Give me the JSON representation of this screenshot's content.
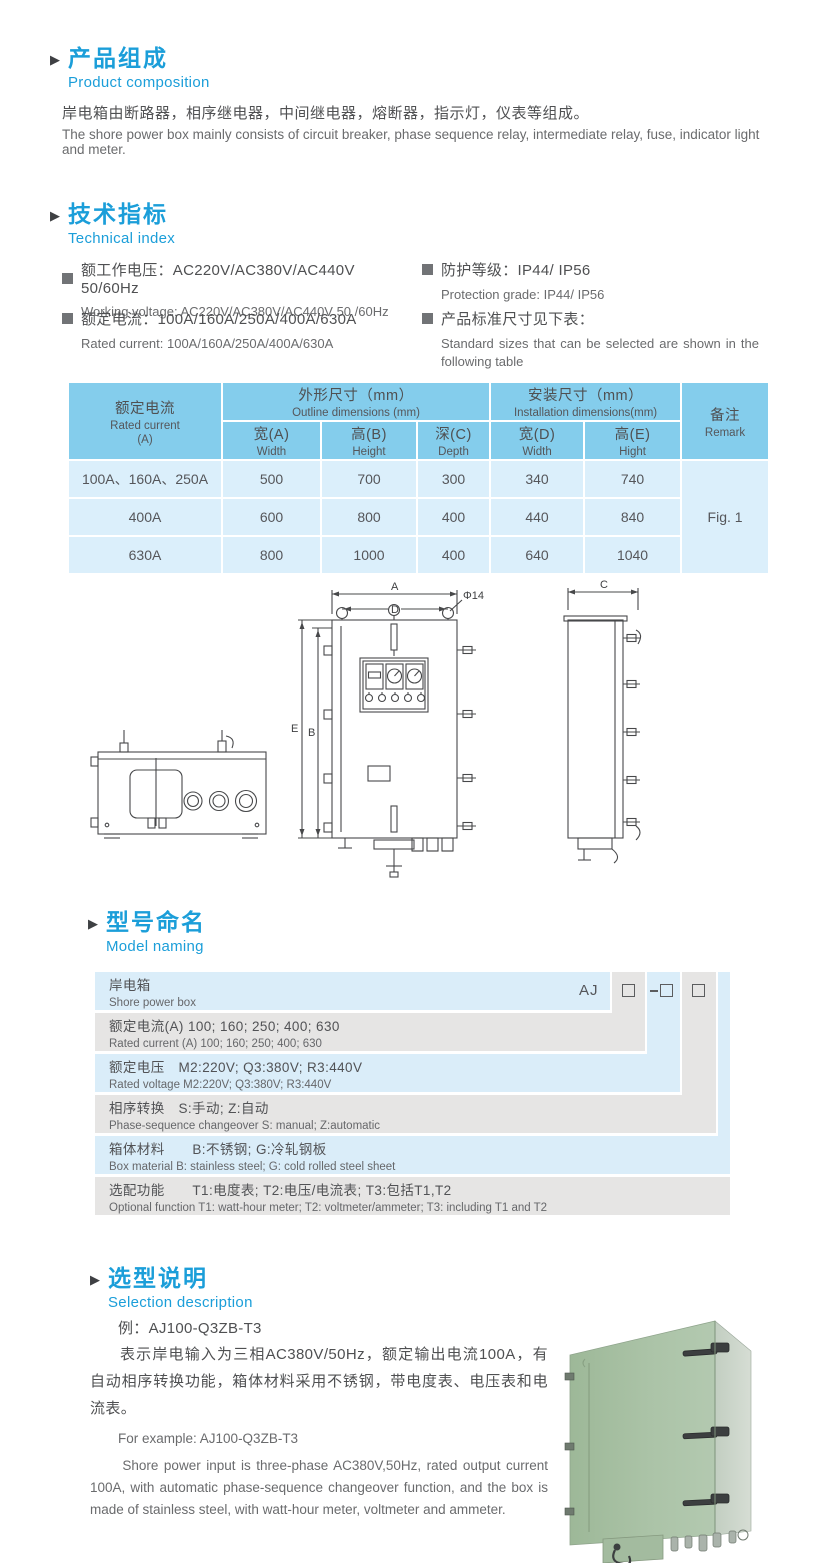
{
  "colors": {
    "accent_blue": "#1b9ed9",
    "table_header_bg": "#84cdec",
    "table_row_bg": "#dbeffb",
    "naming_blue": "#daedf9",
    "naming_gray": "#e6e5e4",
    "cabinet_green": "#a9c2a6",
    "text": "#57585a"
  },
  "composition": {
    "title_zh": "产品组成",
    "title_en": "Product  composition",
    "body_zh": "岸电箱由断路器，相序继电器，中间继电器，熔断器，指示灯，仪表等组成。",
    "body_en": "The shore power box mainly consists of circuit breaker, phase sequence relay, intermediate relay, fuse, indicator light and meter."
  },
  "technical": {
    "title_zh": "技术指标",
    "title_en": "Technical index",
    "specs": [
      {
        "zh": "额工作电压：AC220V/AC380V/AC440V  50/60Hz",
        "en": "Working voltage: AC220V/AC380V/AC440V 50 /60Hz"
      },
      {
        "zh": "额定电流：100A/160A/250A/400A/630A",
        "en": "Rated current: 100A/160A/250A/400A/630A"
      },
      {
        "zh": "防护等级：IP44/ IP56",
        "en": "Protection grade: IP44/ IP56"
      },
      {
        "zh": "产品标准尺寸见下表：",
        "en": "Standard sizes that can be selected are shown in the following table"
      }
    ]
  },
  "table": {
    "col_current": {
      "zh": "额定电流",
      "en": "Rated current",
      "unit": "(A)"
    },
    "group_outline": {
      "zh": "外形尺寸（mm）",
      "en": "Outline dimensions (mm)"
    },
    "group_install": {
      "zh": "安装尺寸（mm）",
      "en": "Installation dimensions(mm)"
    },
    "col_remark": {
      "zh": "备注",
      "en": "Remark"
    },
    "sub": [
      {
        "zh": "宽(A)",
        "en": "Width"
      },
      {
        "zh": "高(B)",
        "en": "Height"
      },
      {
        "zh": "深(C)",
        "en": "Depth"
      },
      {
        "zh": "宽(D)",
        "en": "Width"
      },
      {
        "zh": "高(E)",
        "en": "Hight"
      }
    ],
    "rows": [
      {
        "current": "100A、160A、250A",
        "values": [
          "500",
          "700",
          "300",
          "340",
          "740"
        ]
      },
      {
        "current": "400A",
        "values": [
          "600",
          "800",
          "400",
          "440",
          "840"
        ]
      },
      {
        "current": "630A",
        "values": [
          "800",
          "1000",
          "400",
          "640",
          "1040"
        ]
      }
    ],
    "remark_value": "Fig. 1"
  },
  "drawing": {
    "labels": {
      "a": "A",
      "d": "D",
      "dia": "Φ14",
      "e": "E",
      "b": "B",
      "c": "C"
    }
  },
  "naming": {
    "title_zh": "型号命名",
    "title_en": "Model naming",
    "code_prefix": "AJ",
    "rows": [
      {
        "l1": "岸电箱",
        "l2": "Shore power box"
      },
      {
        "l1": "额定电流(A)  100; 160; 250; 400; 630",
        "l2": "Rated current (A) 100; 160; 250; 400; 630"
      },
      {
        "l1": "额定电压　M2:220V;  Q3:380V;  R3:440V",
        "l2": "Rated voltage  M2:220V;  Q3:380V;  R3:440V"
      },
      {
        "l1": "相序转换　S:手动; Z:自动",
        "l2": "Phase-sequence changeover  S: manual;  Z:automatic"
      },
      {
        "l1": "箱体材料　　B:不锈钢;  G:冷轧钢板",
        "l2": "Box material   B: stainless steel; G: cold rolled steel sheet"
      },
      {
        "l1": "选配功能　　T1:电度表;  T2:电压/电流表; T3:包括T1,T2",
        "l2": "Optional function  T1: watt-hour meter; T2: voltmeter/ammeter; T3: including T1 and T2"
      }
    ]
  },
  "selection": {
    "title_zh": "选型说明",
    "title_en": "Selection description",
    "example_zh": "例：AJ100-Q3ZB-T3",
    "body_zh": "表示岸电输入为三相AC380V/50Hz，额定输出电流100A，有自动相序转换功能，箱体材料采用不锈钢，带电度表、电压表和电流表。",
    "example_en": "For example: AJ100-Q3ZB-T3",
    "body_en": "Shore power input is three-phase AC380V,50Hz, rated output current 100A, with automatic phase-sequence changeover function, and the box is made of stainless steel, with watt-hour meter, voltmeter and ammeter."
  }
}
